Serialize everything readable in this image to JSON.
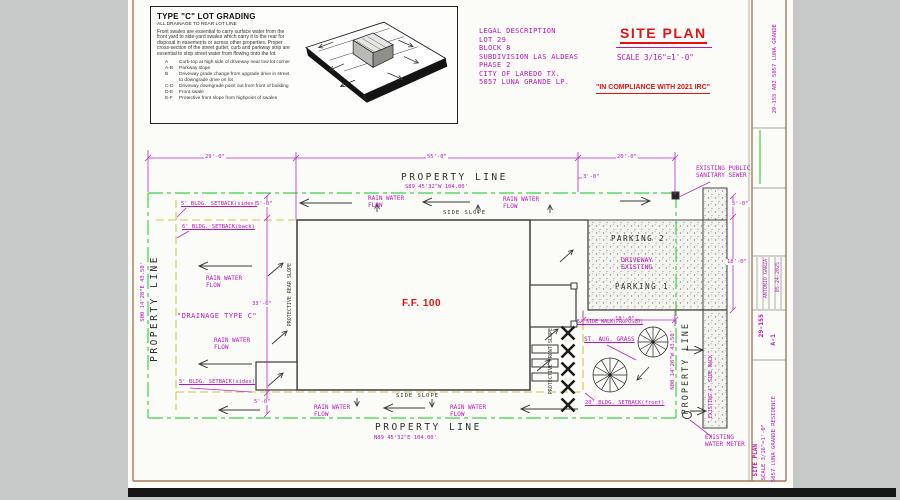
{
  "grading_box": {
    "title": "TYPE \"C\" LOT GRADING",
    "subtitle": "ALL DRAINAGE TO REAR LOT LINE",
    "paragraph": "Front swales are essential to carry surface water from the front yard to side-yard swales which carry it to the rear for disposal in easements or across other properties. Proper cross-section of the street gutter, curb and parkway strip are essential to stop street water from flowing onto the lot.",
    "items": [
      {
        "key": "A",
        "text": "Curb-top at high side of driveway near low lot corner"
      },
      {
        "key": "A-B",
        "text": "Parkway slope"
      },
      {
        "key": "B",
        "text": "Driveway grade change from upgrade drive in street to downgrade drive on lot"
      },
      {
        "key": "C-D",
        "text": "Driveway downgrade point out from front of building"
      },
      {
        "key": "D-E",
        "text": "Front swale"
      },
      {
        "key": "E-F",
        "text": "Protective front slope from highpoint of swales"
      }
    ]
  },
  "legal": {
    "lines": [
      "LEGAL DESCRIPTION",
      "LOT 29",
      "BLOCK 8",
      "SUBDIVISION LAS ALDEAS",
      "PHASE 2",
      "CITY OF LAREDO TX.",
      "5057 LUNA GRANDE LP."
    ]
  },
  "header": {
    "site_plan": "SITE PLAN",
    "scale": "SCALE 3/16\"=1'-0\"",
    "compliance": "\"IN COMPLIANCE WITH 2021 IRC\""
  },
  "plan": {
    "property_line": "PROPERTY LINE",
    "bearings": {
      "top": "S89 45'32\"W 104.00'",
      "bottom": "N89 45'32\"E 104.00'",
      "left": "S00 14'28\"E 43.50'",
      "right": "N00 14'28\"W 43.50'"
    },
    "dims": {
      "d29": "29'-0\"",
      "d55": "55'-0\"",
      "d20": "20'-0\"",
      "d3": "3'-0\"",
      "d5": "5'-0\"",
      "d33": "33'-6\"",
      "d18": "18'-0\""
    },
    "labels": {
      "rain_flow": "RAIN WATER\nFLOW",
      "side_slope": "SIDE SLOPE",
      "setback_sides": "5' BLDG. SETBACK(sides)",
      "setback_back": "6' BLDG. SETBACK(back)",
      "setback_front": "20' BLDG. SETBACK(front)",
      "sidewalk_proposed": "5' SIDE WALK(PROPOSED)",
      "drainage_type": "\"DRAINAGE TYPE C\"",
      "finish_floor": "F.F. 100",
      "protective_rear": "PROTECTIVE REAR SLOPE",
      "protective_front": "PROTECTIVE FRONT SLOPE",
      "parking_2": "PARKING 2",
      "parking_1": "PARKING 1",
      "driveway": "DRIVEWAY\nEXISTING",
      "sewer": "EXISTING PUBLIC\nSANITARY SEWER",
      "water_meter": "EXISTING\nWATER METER",
      "sidewalk_existing": "EXISTING 4' SIDE WALK",
      "st_aug_grass": "ST. AUG. GRASS"
    }
  },
  "title_block": {
    "side_note": "29-155  A02  5057 LUNA GRANDE",
    "designer": "ANTONIO GARZA",
    "date": "05-24-2025",
    "job_number": "29-155",
    "sheet": "A-1",
    "title": "SITE PLAN",
    "scale": "SCALE 3/16\"=1'-0\"",
    "project": "5057 LUNA GRANDE RESIDENCE"
  }
}
